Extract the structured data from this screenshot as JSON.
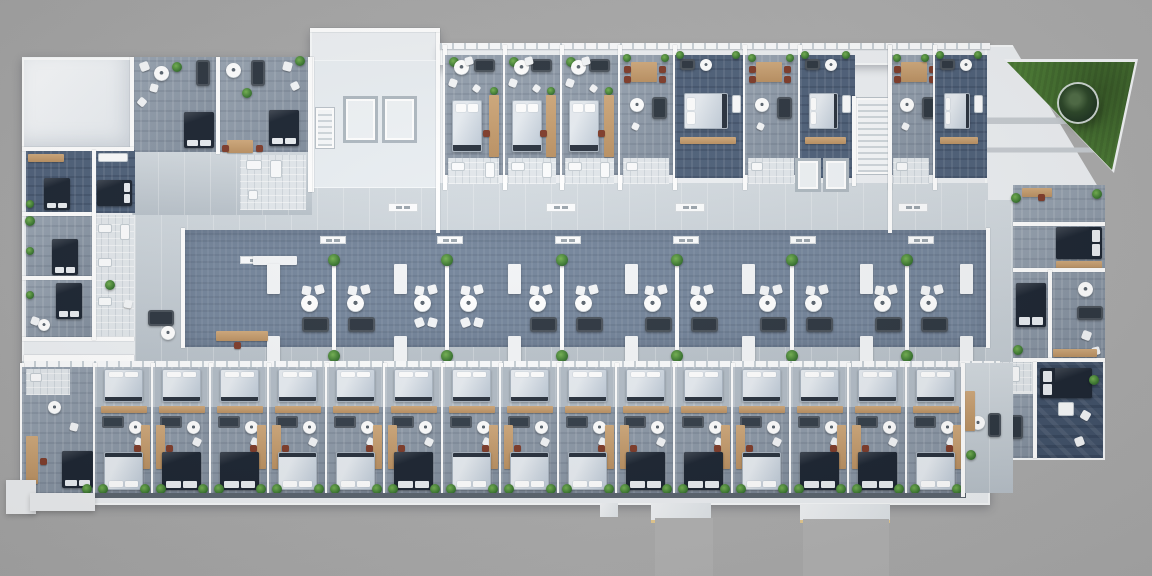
{
  "scene": {
    "kind": "apartment-building-floor-plan-3d-render-top-view"
  },
  "palette": {
    "ground": "#a7a7a7",
    "building_white": "#edf0f3",
    "roof_white": "#f3f5f7",
    "floor_light": "#8d9aa9",
    "floor_dark": "#4d5f78",
    "floor_deep": "#3f5068",
    "walkway": "#c7d0d7",
    "courtyard_center": "#73849a",
    "wall": "#ffffff",
    "wood": "#c49d6f",
    "bed_dark": "#1a2330",
    "bed_light": "#d8dfe6",
    "sofa": "#2c353f",
    "plant": "#4e8a38",
    "lawn": "#4b7c33",
    "tree": "#24381f",
    "bath": "#e2e7eb",
    "dining_chair": "#7e3a28",
    "patio_trim": "#e5c98f"
  },
  "bases": [
    {
      "x": 22,
      "y": 57,
      "w": 968,
      "h": 448
    },
    {
      "x": 310,
      "y": 30,
      "w": 130,
      "h": 40
    },
    {
      "x": 440,
      "y": 45,
      "w": 550,
      "h": 20
    },
    {
      "x": 985,
      "y": 45,
      "w": 120,
      "h": 415,
      "clip": "polygon(0% 0%, 23% 0%, 100% 37%, 100% 100%, 0% 100%)"
    }
  ],
  "roof": {
    "x": 22,
    "y": 58,
    "w": 110,
    "h": 92
  },
  "terrace": {
    "x": 985,
    "y": 40,
    "w": 155,
    "h": 168,
    "poly": "polygon(0px 0px, 153px 17px, 128px 132px, 118px 165px, 0px 165px)"
  },
  "lawn": {
    "x": 1000,
    "y": 55,
    "w": 145,
    "h": 122,
    "white_poly": "polygon(4px 4px, 138px 4px, 114px 118px)",
    "green_poly": "polygon(7px 7px, 135px 7px, 112px 115px)",
    "tree": {
      "cx": 78,
      "cy": 48,
      "r": 19
    }
  },
  "walk_areas": [
    [
      135,
      183,
      853,
      187
    ],
    [
      132,
      150,
      180,
      65
    ],
    [
      963,
      363,
      50,
      130
    ],
    [
      985,
      200,
      28,
      262
    ]
  ],
  "courtyard": {
    "center": [
      183,
      230,
      805,
      117
    ],
    "end_walls": [
      [
        181,
        228,
        4,
        120
      ],
      [
        986,
        228,
        4,
        120
      ]
    ],
    "dividers": [
      {
        "x": 332,
        "type": "sofa"
      },
      {
        "x": 445,
        "type": "chairs"
      },
      {
        "x": 560,
        "type": "sofa"
      },
      {
        "x": 675,
        "type": "sofa"
      },
      {
        "x": 790,
        "type": "sofa"
      },
      {
        "x": 905,
        "type": "sofa"
      }
    ],
    "divider_y": 266,
    "divider_h": 84,
    "cluster_offsets": [
      -32,
      14
    ],
    "benches_x": [
      267,
      394,
      508,
      625,
      742,
      860,
      960
    ],
    "bench_rows_y": [
      264,
      336
    ],
    "long_bench": [
      253,
      256,
      44,
      9
    ],
    "vents": {
      "top_y": 236,
      "top_x": [
        320,
        437,
        555,
        673,
        790,
        908
      ],
      "extra": [
        240,
        256
      ],
      "corridor_y": 203,
      "corridor_x": [
        388,
        546,
        675,
        898
      ]
    }
  },
  "core": [
    [
      "lobby",
      [
        312,
        60,
        126,
        128
      ]
    ],
    [
      "elev",
      [
        343,
        96,
        35,
        47
      ]
    ],
    [
      "elev",
      [
        382,
        96,
        35,
        47
      ]
    ],
    [
      "stairsV",
      [
        316,
        108,
        18,
        40
      ]
    ],
    [
      "wall",
      [
        310,
        57,
        4,
        135
      ]
    ],
    [
      "wall",
      [
        436,
        30,
        4,
        203
      ]
    ],
    [
      "wall",
      [
        310,
        28,
        130,
        4
      ]
    ]
  ],
  "core2": [
    [
      "stairsV",
      [
        856,
        98,
        34,
        76
      ]
    ],
    [
      "elev",
      [
        795,
        158,
        26,
        34
      ]
    ],
    [
      "elev",
      [
        823,
        158,
        26,
        34
      ]
    ],
    [
      "wall",
      [
        852,
        96,
        4,
        90
      ]
    ],
    [
      "wall",
      [
        888,
        45,
        4,
        188
      ]
    ]
  ],
  "top_band_wall": [
    440,
    43,
    550,
    6
  ],
  "top_units": [
    {
      "x": 445,
      "w": 60,
      "t": "A"
    },
    {
      "x": 505,
      "w": 57,
      "t": "A"
    },
    {
      "x": 562,
      "w": 58,
      "t": "A"
    },
    {
      "x": 620,
      "w": 55,
      "t": "D"
    },
    {
      "x": 675,
      "w": 70,
      "t": "C"
    },
    {
      "x": 745,
      "w": 55,
      "t": "D"
    },
    {
      "x": 800,
      "w": 55,
      "t": "C"
    },
    {
      "x": 890,
      "w": 45,
      "t": "D"
    },
    {
      "x": 935,
      "w": 52,
      "t": "C"
    }
  ],
  "left_top": [
    [
      "floor",
      [
        132,
        57,
        86,
        95
      ]
    ],
    [
      "floor",
      [
        218,
        57,
        92,
        95
      ]
    ],
    [
      "wall",
      [
        130,
        57,
        4,
        97
      ]
    ],
    [
      "wall",
      [
        216,
        57,
        4,
        97
      ]
    ],
    [
      "wall",
      [
        308,
        57,
        4,
        135
      ]
    ],
    [
      "cw",
      [
        140,
        62,
        9,
        -20
      ]
    ],
    [
      "cw",
      [
        150,
        84,
        8,
        15
      ]
    ],
    [
      "cw",
      [
        138,
        98,
        8,
        40
      ]
    ],
    [
      "rt",
      [
        161,
        73,
        15
      ]
    ],
    [
      "sofa",
      [
        196,
        60,
        14,
        26
      ]
    ],
    [
      "bedD",
      [
        184,
        112,
        30,
        36,
        "b"
      ]
    ],
    [
      "plant",
      [
        177,
        67,
        5
      ]
    ],
    [
      "rt",
      [
        233,
        70,
        15
      ]
    ],
    [
      "sofa",
      [
        251,
        60,
        14,
        26
      ]
    ],
    [
      "cw",
      [
        283,
        62,
        9,
        15
      ]
    ],
    [
      "cw",
      [
        291,
        82,
        8,
        -25
      ]
    ],
    [
      "bedD",
      [
        269,
        110,
        30,
        36,
        "b"
      ]
    ],
    [
      "wood",
      [
        227,
        140,
        26,
        13
      ]
    ],
    [
      "cr",
      [
        222,
        145
      ]
    ],
    [
      "cr",
      [
        256,
        145
      ]
    ],
    [
      "plant",
      [
        247,
        93,
        5
      ]
    ],
    [
      "plant",
      [
        300,
        61,
        5
      ]
    ],
    [
      "bath",
      [
        240,
        155,
        66,
        55
      ]
    ],
    [
      "fix",
      [
        246,
        160,
        16,
        10
      ]
    ],
    [
      "fix",
      [
        270,
        160,
        12,
        18
      ]
    ],
    [
      "fix",
      [
        248,
        190,
        10,
        10
      ]
    ]
  ],
  "left_wing": [
    [
      "floorD",
      [
        26,
        150,
        66,
        64
      ]
    ],
    [
      "bedD",
      [
        44,
        178,
        26,
        32,
        "b"
      ]
    ],
    [
      "wood",
      [
        28,
        154,
        36,
        8
      ]
    ],
    [
      "plant",
      [
        30,
        204,
        4
      ]
    ],
    [
      "floorD",
      [
        95,
        150,
        40,
        63
      ]
    ],
    [
      "fix",
      [
        98,
        153,
        30,
        9
      ]
    ],
    [
      "bedD",
      [
        97,
        180,
        35,
        26,
        "r"
      ]
    ],
    [
      "floor",
      [
        26,
        215,
        66,
        62
      ]
    ],
    [
      "bedD",
      [
        52,
        239,
        26,
        36,
        "b"
      ]
    ],
    [
      "plant",
      [
        30,
        221,
        5
      ]
    ],
    [
      "floor",
      [
        26,
        278,
        66,
        60
      ]
    ],
    [
      "bedD",
      [
        56,
        283,
        26,
        36,
        "b"
      ]
    ],
    [
      "rt",
      [
        44,
        325,
        12
      ]
    ],
    [
      "cw",
      [
        31,
        317,
        8,
        20
      ]
    ],
    [
      "bath",
      [
        94,
        215,
        40,
        122
      ]
    ],
    [
      "fix",
      [
        98,
        224,
        14,
        9
      ]
    ],
    [
      "fix",
      [
        98,
        258,
        14,
        9
      ]
    ],
    [
      "fix",
      [
        98,
        297,
        14,
        9
      ]
    ],
    [
      "fix",
      [
        120,
        224,
        10,
        16
      ]
    ],
    [
      "wall",
      [
        22,
        147,
        112,
        4
      ]
    ],
    [
      "wall",
      [
        22,
        212,
        72,
        4
      ]
    ],
    [
      "wall",
      [
        22,
        276,
        72,
        4
      ]
    ],
    [
      "wall",
      [
        22,
        337,
        112,
        4
      ]
    ],
    [
      "wall",
      [
        92,
        150,
        4,
        190
      ]
    ],
    [
      "wall",
      [
        24,
        355,
        110,
        9
      ]
    ],
    [
      "plant",
      [
        30,
        251,
        4
      ]
    ],
    [
      "plant",
      [
        30,
        295,
        4
      ]
    ],
    [
      "plant",
      [
        110,
        285,
        5
      ]
    ],
    [
      "sofa",
      [
        148,
        310,
        26,
        16
      ]
    ],
    [
      "rt",
      [
        168,
        333,
        14
      ]
    ],
    [
      "wood",
      [
        216,
        331,
        52,
        10
      ]
    ],
    [
      "cr",
      [
        234,
        342
      ]
    ],
    [
      "cw",
      [
        124,
        300,
        8,
        10
      ]
    ]
  ],
  "right_wing": [
    [
      "floor",
      [
        1013,
        185,
        92,
        175
      ]
    ],
    [
      "floorDeep",
      [
        1035,
        362,
        68,
        96
      ]
    ],
    [
      "bath",
      [
        988,
        362,
        44,
        30
      ]
    ],
    [
      "fix",
      [
        992,
        366,
        12,
        9
      ]
    ],
    [
      "fix",
      [
        1010,
        366,
        10,
        16
      ]
    ],
    [
      "floor",
      [
        988,
        394,
        46,
        64
      ]
    ],
    [
      "wood",
      [
        1022,
        188,
        30,
        9
      ]
    ],
    [
      "cr",
      [
        1038,
        194
      ]
    ],
    [
      "plant",
      [
        1016,
        198,
        5
      ]
    ],
    [
      "plant",
      [
        1097,
        194,
        5
      ]
    ],
    [
      "bedD",
      [
        1056,
        227,
        46,
        32,
        "r"
      ]
    ],
    [
      "wood",
      [
        1056,
        261,
        46,
        8
      ]
    ],
    [
      "wall",
      [
        1013,
        222,
        92,
        4
      ]
    ],
    [
      "wall",
      [
        1013,
        268,
        92,
        4
      ]
    ],
    [
      "wall",
      [
        1048,
        270,
        4,
        88
      ]
    ],
    [
      "wall",
      [
        1013,
        358,
        92,
        4
      ]
    ],
    [
      "wall",
      [
        1033,
        362,
        4,
        96
      ]
    ],
    [
      "bedD",
      [
        1016,
        283,
        30,
        44,
        "b"
      ]
    ],
    [
      "rt",
      [
        1085,
        289,
        15
      ]
    ],
    [
      "sofa",
      [
        1077,
        306,
        26,
        14
      ]
    ],
    [
      "cw",
      [
        1082,
        331,
        9,
        20
      ]
    ],
    [
      "cw",
      [
        1092,
        347,
        8,
        -15
      ]
    ],
    [
      "wood",
      [
        1053,
        349,
        44,
        8
      ]
    ],
    [
      "bedD",
      [
        1040,
        368,
        52,
        30,
        "l"
      ]
    ],
    [
      "fix",
      [
        1058,
        402,
        16,
        14
      ]
    ],
    [
      "cw",
      [
        1081,
        411,
        9,
        30
      ]
    ],
    [
      "cw",
      [
        1075,
        437,
        9,
        -20
      ]
    ],
    [
      "plant",
      [
        1094,
        380,
        5
      ]
    ],
    [
      "rt",
      [
        999,
        425,
        14
      ]
    ],
    [
      "sofa",
      [
        1010,
        415,
        13,
        24
      ]
    ],
    [
      "wood",
      [
        990,
        400,
        10,
        30
      ]
    ],
    [
      "plant",
      [
        993,
        450,
        5
      ]
    ],
    [
      "plant",
      [
        1018,
        350,
        5
      ]
    ]
  ],
  "bottom_band": {
    "top_wall": [
      22,
      361,
      978,
      6
    ],
    "bottom_edge": [
      22,
      493,
      944,
      5
    ]
  },
  "bottom_units": [
    {
      "x": 22,
      "w": 73,
      "special": true,
      "bed": "dark",
      "desk": "left"
    },
    {
      "x": 95,
      "w": 58,
      "bed": "light",
      "desk": "right"
    },
    {
      "x": 153,
      "w": 58,
      "bed": "dark",
      "desk": "left"
    },
    {
      "x": 211,
      "w": 58,
      "bed": "dark",
      "desk": "right"
    },
    {
      "x": 269,
      "w": 58,
      "bed": "light",
      "desk": "left"
    },
    {
      "x": 327,
      "w": 58,
      "bed": "light",
      "desk": "right"
    },
    {
      "x": 385,
      "w": 58,
      "bed": "dark",
      "desk": "left"
    },
    {
      "x": 443,
      "w": 58,
      "bed": "light",
      "desk": "right"
    },
    {
      "x": 501,
      "w": 58,
      "bed": "light",
      "desk": "left"
    },
    {
      "x": 559,
      "w": 58,
      "bed": "light",
      "desk": "right"
    },
    {
      "x": 617,
      "w": 58,
      "bed": "dark",
      "desk": "left"
    },
    {
      "x": 675,
      "w": 58,
      "bed": "dark",
      "desk": "right"
    },
    {
      "x": 733,
      "w": 58,
      "bed": "light",
      "desk": "left"
    },
    {
      "x": 791,
      "w": 58,
      "bed": "dark",
      "desk": "right"
    },
    {
      "x": 849,
      "w": 58,
      "bed": "dark",
      "desk": "left"
    },
    {
      "x": 907,
      "w": 58,
      "bed": "light",
      "desk": "right"
    }
  ],
  "entry_right": [
    [
      "walk",
      [
        963,
        363,
        50,
        130
      ]
    ],
    [
      "rt",
      [
        978,
        423,
        14
      ]
    ],
    [
      "sofa",
      [
        988,
        413,
        13,
        24
      ]
    ],
    [
      "wood",
      [
        965,
        391,
        10,
        40
      ]
    ],
    [
      "plant",
      [
        971,
        455,
        5
      ]
    ],
    [
      "wall",
      [
        961,
        363,
        4,
        134
      ]
    ]
  ],
  "aprons": [
    [
      6,
      480,
      30,
      34
    ],
    [
      30,
      493,
      65,
      18
    ]
  ],
  "patios": [
    {
      "r": [
        600,
        503,
        18,
        14
      ],
      "tan": false
    },
    {
      "r": [
        651,
        503,
        60,
        17
      ],
      "tan": true
    },
    {
      "r": [
        800,
        504,
        90,
        16
      ],
      "tan": true
    }
  ],
  "paths": [
    [
      655,
      518,
      58,
      58
    ],
    [
      803,
      519,
      86,
      57
    ]
  ]
}
